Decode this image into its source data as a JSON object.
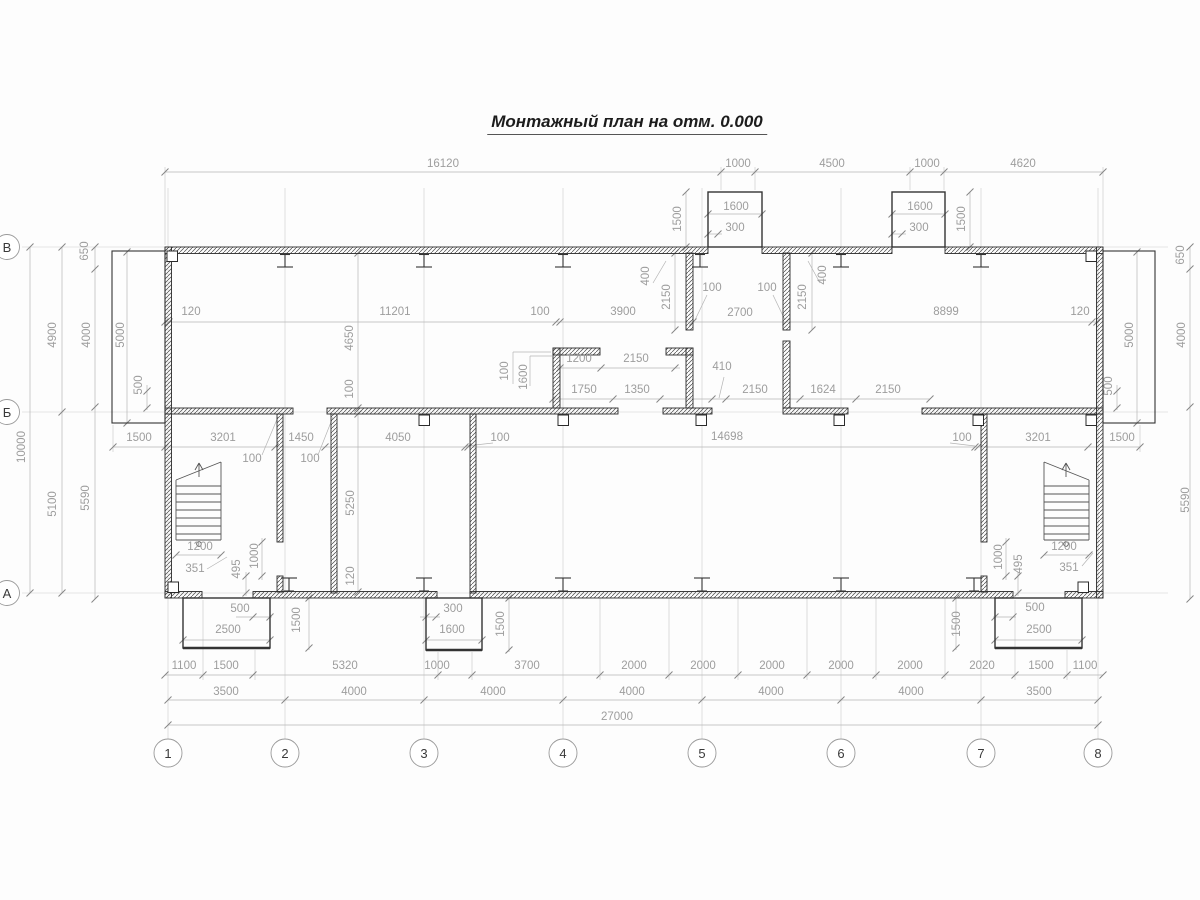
{
  "title": "Монтажный план на отм. 0.000",
  "axes": {
    "rows": [
      "В",
      "Б",
      "А"
    ],
    "cols": [
      "1",
      "2",
      "3",
      "4",
      "5",
      "6",
      "7",
      "8"
    ]
  },
  "dims": [
    "16120",
    "1000",
    "4500",
    "1000",
    "4620",
    "1600",
    "300",
    "1500",
    "1600",
    "300",
    "1500",
    "650",
    "650",
    "120",
    "11201",
    "100",
    "3900",
    "2700",
    "8899",
    "120",
    "4900",
    "4000",
    "5000",
    "10000",
    "5100",
    "5590",
    "500",
    "1500",
    "5000",
    "4000",
    "500",
    "5590",
    "400",
    "2150",
    "100",
    "100",
    "2150",
    "400",
    "4650",
    "100",
    "100",
    "1600",
    "1200",
    "2150",
    "410",
    "1750",
    "1350",
    "2150",
    "1624",
    "2150",
    "3201",
    "1450",
    "4050",
    "100",
    "14698",
    "100",
    "3201",
    "1500",
    "100",
    "100",
    "5250",
    "120",
    "1200",
    "351",
    "495",
    "1000",
    "500",
    "2500",
    "1500",
    "300",
    "1600",
    "1500",
    "1000",
    "495",
    "1200",
    "351",
    "500",
    "2500",
    "1500",
    "1100",
    "1500",
    "5320",
    "1000",
    "3700",
    "2000",
    "2000",
    "2000",
    "2000",
    "2000",
    "2020",
    "1500",
    "1100",
    "3500",
    "4000",
    "4000",
    "4000",
    "4000",
    "4000",
    "3500",
    "27000"
  ],
  "colors": {
    "wall": "#2b2b2b",
    "dim_text": "#9d9d9d",
    "dim_line": "#b4b4b4",
    "axis_line": "#cdcdcd"
  }
}
